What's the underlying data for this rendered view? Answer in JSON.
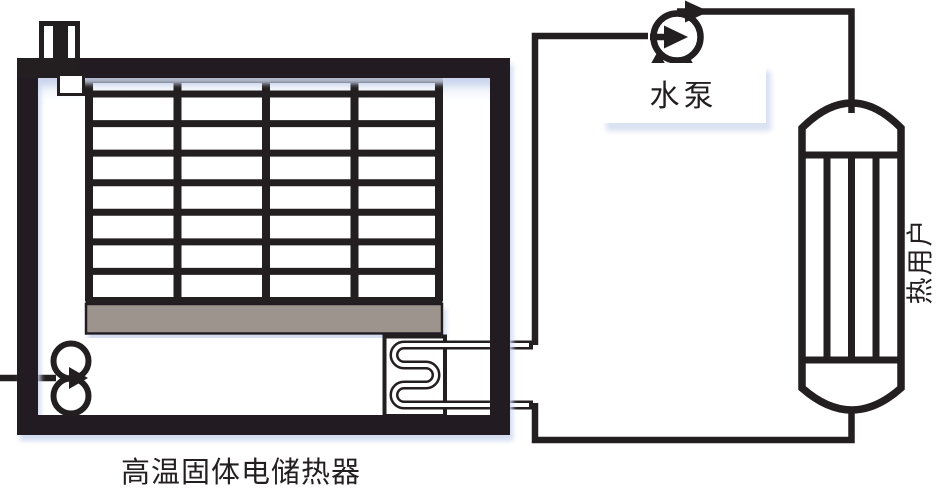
{
  "figure": {
    "title": "高温固体电储热器",
    "pump_label": "水泵",
    "heat_user_label": "热用户"
  },
  "icons": {
    "pump": "circle-with-flow-arrow-pump-symbol",
    "fan": "double-circle-fan-symbol",
    "heat_exchanger": "serpentine-coil-symbol",
    "heating_element": "electrode-terminal-symbol"
  },
  "colors": {
    "line": "#231f20",
    "plate": "#9d948e",
    "shadow": "#d9e1f2",
    "cellshade": "#b9c9e6",
    "background": "#ffffff"
  }
}
